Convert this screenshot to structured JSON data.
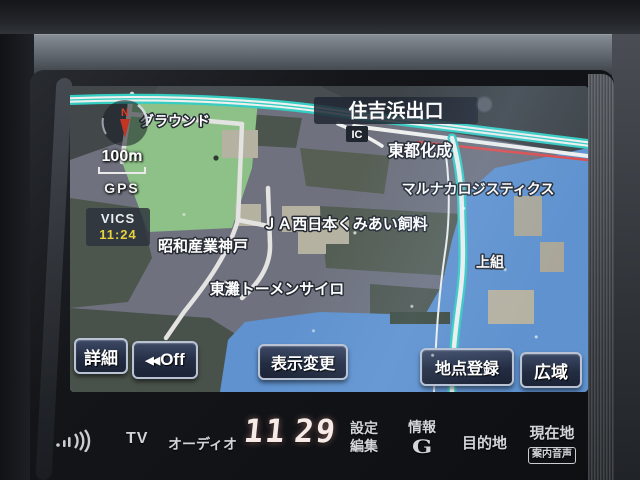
{
  "colors": {
    "sea": "#5f92cf",
    "land": "#6f727e",
    "park_green": "#8dc188",
    "road_teal": "#36cdc3",
    "traffic_red": "#e04b4b",
    "vics_time_yellow": "#e6d23e",
    "button_navy": "#232c42",
    "clock_white": "#f6ebe7"
  },
  "screen": {
    "compass": {
      "north": "N"
    },
    "scale_label": "100m",
    "gps_label": "GPS",
    "vics": {
      "label": "VICS",
      "time": "11:24"
    },
    "map": {
      "labels": {
        "ground": "グラウンド",
        "exit": "住吉浜出口",
        "ic": "IC",
        "toutokasei": "東都化成",
        "marunaka_logistics": "マルナカロジスティクス",
        "ja_feed": "ＪＡ西日本くみあい飼料",
        "showa_sangyo": "昭和産業神戸",
        "tomen_silo": "東灘トーメンサイロ",
        "kamigumi": "上組"
      }
    },
    "buttons": {
      "detail": "詳細",
      "off_icon": "◀◀",
      "off": "Off",
      "display_change": "表示変更",
      "point_register": "地点登録",
      "wide_area": "広域"
    }
  },
  "panel": {
    "tv": "TV",
    "audio": "オーディオ",
    "clock": {
      "hours": "11",
      "minutes": "29"
    },
    "settings": {
      "line1": "設定",
      "line2": "編集"
    },
    "info": "情報",
    "g_mark": "G",
    "destination": "目的地",
    "current_location": "現在地",
    "guide_voice": "案内音声"
  }
}
